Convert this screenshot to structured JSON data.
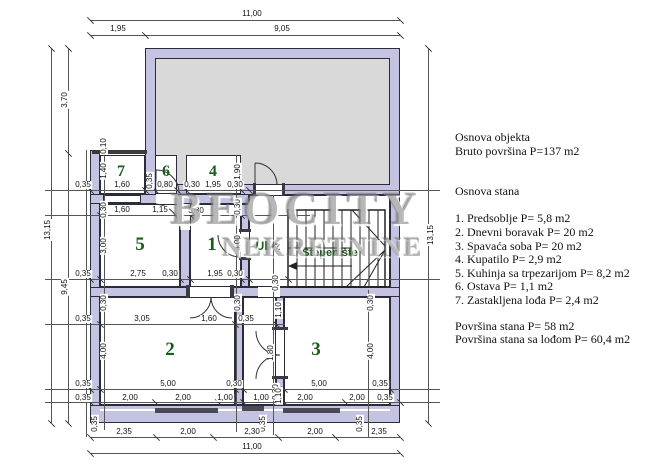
{
  "watermark": {
    "line1": "BEOCITY",
    "line2": "NEKRETNINE"
  },
  "info": {
    "lines": [
      [
        "Osnova objekta",
        140
      ],
      [
        "Bruto površina P=137 m2",
        154
      ],
      [
        "Osnova stana",
        194
      ],
      [
        "1. Predsoblje P= 5,8 m2",
        221
      ],
      [
        "2. Dnevni boravak P= 20 m2",
        235
      ],
      [
        "3. Spavaća soba P= 20 m2",
        249
      ],
      [
        "4. Kupatilo P= 2,9 m2",
        262
      ],
      [
        "5. Kuhinja sa trpezarijom P= 8,2 m2",
        276
      ],
      [
        "6. Ostava P= 1,1 m2",
        289
      ],
      [
        "7. Zastakljena lođa P= 2,4 m2",
        303
      ],
      [
        "Površina stana P= 58 m2",
        329
      ],
      [
        "Površina stana sa lođom P= 60,4 m2",
        342
      ]
    ]
  },
  "plan": {
    "rooms": [
      [
        "7",
        121,
        172,
        16
      ],
      [
        "6",
        166,
        172,
        16
      ],
      [
        "4",
        213,
        172,
        16
      ],
      [
        "5",
        140,
        245,
        19
      ],
      [
        "1",
        212,
        245,
        19
      ],
      [
        "2",
        170,
        350,
        19
      ],
      [
        "3",
        316,
        350,
        19
      ]
    ],
    "glabels": [
      [
        "Ulaz",
        268,
        246,
        12
      ],
      [
        "Stepenište",
        330,
        253,
        11
      ]
    ],
    "hlines": [
      [
        90,
        20,
        310
      ],
      [
        90,
        35,
        310
      ],
      [
        45,
        190,
        395
      ],
      [
        45,
        215,
        265
      ],
      [
        45,
        279,
        395
      ],
      [
        45,
        324,
        240
      ],
      [
        45,
        389,
        395
      ],
      [
        45,
        402,
        395
      ],
      [
        90,
        437,
        310
      ],
      [
        90,
        453,
        310
      ]
    ],
    "vlines": [
      [
        51,
        48,
        375
      ],
      [
        68,
        48,
        375
      ],
      [
        86,
        150,
        287
      ],
      [
        104,
        145,
        285
      ],
      [
        236,
        155,
        277
      ],
      [
        273,
        195,
        240
      ],
      [
        368,
        290,
        147
      ],
      [
        428,
        48,
        375
      ]
    ],
    "ticks": [
      [
        90,
        20
      ],
      [
        400,
        20
      ],
      [
        90,
        35
      ],
      [
        145,
        35
      ],
      [
        400,
        35
      ],
      [
        90,
        437
      ],
      [
        156,
        437
      ],
      [
        213,
        437
      ],
      [
        278,
        437
      ],
      [
        335,
        437
      ],
      [
        400,
        437
      ],
      [
        90,
        453
      ],
      [
        400,
        453
      ],
      [
        51,
        48
      ],
      [
        51,
        423
      ],
      [
        68,
        48
      ],
      [
        68,
        153
      ],
      [
        68,
        423
      ],
      [
        428,
        48
      ],
      [
        428,
        423
      ],
      [
        90,
        190
      ],
      [
        145,
        190
      ],
      [
        155,
        190
      ],
      [
        177,
        190
      ],
      [
        186,
        190
      ],
      [
        241,
        190
      ],
      [
        249,
        190
      ],
      [
        100,
        215
      ],
      [
        180,
        215
      ],
      [
        190,
        215
      ],
      [
        241,
        215
      ],
      [
        90,
        279
      ],
      [
        100,
        279
      ],
      [
        180,
        279
      ],
      [
        190,
        279
      ],
      [
        241,
        279
      ],
      [
        249,
        279
      ],
      [
        288,
        279
      ],
      [
        100,
        324
      ],
      [
        235,
        324
      ],
      [
        276,
        324
      ],
      [
        90,
        389
      ],
      [
        100,
        389
      ],
      [
        235,
        389
      ],
      [
        243,
        389
      ],
      [
        276,
        389
      ],
      [
        284,
        389
      ],
      [
        390,
        389
      ],
      [
        90,
        402
      ],
      [
        155,
        402
      ],
      [
        218,
        402
      ],
      [
        243,
        402
      ],
      [
        284,
        402
      ],
      [
        345,
        402
      ],
      [
        400,
        402
      ]
    ],
    "dims": [
      [
        "11,00",
        252,
        14,
        0
      ],
      [
        "1,95",
        118,
        29,
        0
      ],
      [
        "9,05",
        282,
        29,
        0
      ],
      [
        "13,15",
        48,
        230,
        1
      ],
      [
        "3,70",
        65,
        100,
        1
      ],
      [
        "9,45",
        65,
        287,
        1
      ],
      [
        "13,15",
        431,
        235,
        1
      ],
      [
        "0,35",
        83,
        185,
        0
      ],
      [
        "1,60",
        122,
        185,
        0
      ],
      [
        "0,35",
        150,
        181,
        1
      ],
      [
        "0,80",
        165,
        185,
        0
      ],
      [
        "0,30",
        192,
        185,
        0
      ],
      [
        "1,95",
        213,
        185,
        0
      ],
      [
        "0,30",
        235,
        185,
        0
      ],
      [
        "0,10",
        104,
        146,
        1
      ],
      [
        "1,40",
        104,
        171,
        1
      ],
      [
        "1,90",
        238,
        172,
        1
      ],
      [
        "0,30",
        104,
        210,
        1
      ],
      [
        "1,60",
        122,
        210,
        0
      ],
      [
        "1,15",
        160,
        210,
        0
      ],
      [
        "0,30",
        196,
        211,
        0
      ],
      [
        "0,30",
        238,
        207,
        1
      ],
      [
        "3,00",
        104,
        246,
        1
      ],
      [
        "3,00",
        238,
        243,
        1
      ],
      [
        "0,35",
        83,
        274,
        0
      ],
      [
        "2,75",
        138,
        274,
        0
      ],
      [
        "0,30",
        170,
        274,
        0
      ],
      [
        "1,95",
        215,
        274,
        0
      ],
      [
        "0,30",
        235,
        274,
        0
      ],
      [
        "0,30",
        276,
        283,
        1
      ],
      [
        "0,30",
        104,
        303,
        1
      ],
      [
        "0,30",
        238,
        303,
        1
      ],
      [
        "1,10",
        279,
        310,
        1
      ],
      [
        "0,30",
        371,
        303,
        1
      ],
      [
        "0,35",
        83,
        319,
        0
      ],
      [
        "3,05",
        142,
        319,
        0
      ],
      [
        "1,60",
        209,
        319,
        0
      ],
      [
        "0,35",
        246,
        319,
        0
      ],
      [
        "4,00",
        104,
        351,
        1
      ],
      [
        "1,80",
        271,
        353,
        1
      ],
      [
        "4,00",
        371,
        351,
        1
      ],
      [
        "0,35",
        83,
        384,
        0
      ],
      [
        "5,00",
        168,
        384,
        0
      ],
      [
        "0,30",
        234,
        384,
        0
      ],
      [
        "0,30",
        276,
        392,
        1
      ],
      [
        "5,00",
        319,
        384,
        0
      ],
      [
        "0,35",
        380,
        384,
        0
      ],
      [
        "0,35",
        83,
        398,
        0
      ],
      [
        "2,00",
        130,
        398,
        0
      ],
      [
        "2,00",
        183,
        398,
        0
      ],
      [
        "1,00",
        225,
        398,
        0
      ],
      [
        "1,00",
        261,
        398,
        0
      ],
      [
        "1,10",
        279,
        396,
        1
      ],
      [
        "2,00",
        305,
        398,
        0
      ],
      [
        "2,00",
        357,
        398,
        0
      ],
      [
        "0,35",
        385,
        398,
        0
      ],
      [
        "0,35",
        95,
        424,
        1
      ],
      [
        "0,35",
        263,
        424,
        1
      ],
      [
        "0,35",
        360,
        424,
        1
      ],
      [
        "2,35",
        124,
        432,
        0
      ],
      [
        "2,00",
        188,
        432,
        0
      ],
      [
        "2,30",
        252,
        432,
        0
      ],
      [
        "2,00",
        315,
        432,
        0
      ],
      [
        "2,35",
        379,
        432,
        0
      ],
      [
        "11,00",
        252,
        447,
        0
      ]
    ]
  }
}
